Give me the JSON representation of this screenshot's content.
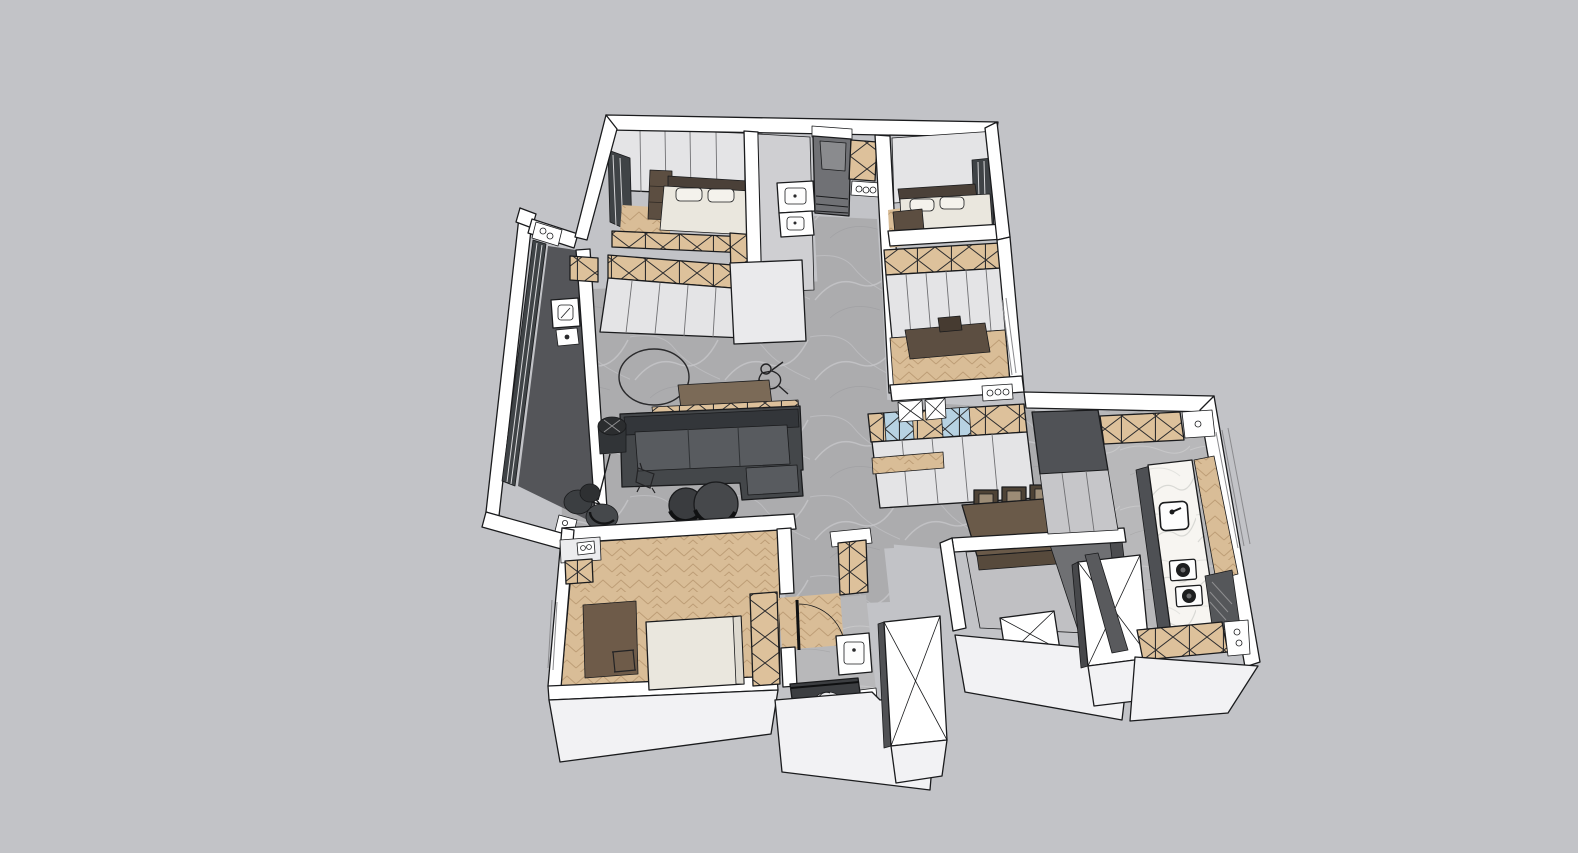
{
  "meta": {
    "title": "SketchUp-style 3D apartment floor plan model, top-down axonometric view on plain gray background",
    "application_chrome": "none",
    "visible_text": "none"
  },
  "palette": {
    "bg": "#c2c3c7",
    "wall": "#ffffff",
    "wallface": "#f2f2f4",
    "line": "#1a1b1d",
    "face": "#e4e4e6",
    "faceshade": "#cfcfd2",
    "facedark": "#9a9b9e",
    "concrete": "#acacae",
    "concvein": "#c7c7c9",
    "tile": "#b8b8ba",
    "wood": "#d9bd97",
    "woodline": "#bd9d76",
    "xwood": "#ddc19b",
    "xblue": "#b7d2e2",
    "darkwood": "#5c4e41",
    "headboard": "#4a4038",
    "cream": "#eae7de",
    "marble": "#f7f5f1",
    "glass": "#3f4346",
    "darkfloor": "#545559",
    "sofa": "#44474a",
    "sofaback": "#33363a",
    "sofaseat": "#585b5f",
    "tabletop": "#6a5a49",
    "shadowface": "#6f7073"
  },
  "scene": {
    "type": "3d-floor-plan-render",
    "style": "sketchup-white-model",
    "rooms": [
      {
        "name": "master-bedroom",
        "position": "top-left",
        "items": [
          "double-bed",
          "white-pillows",
          "dark-headboard",
          "dresser",
          "nightstand",
          "herringbone-floor",
          "x-front-wardrobe"
        ]
      },
      {
        "name": "vanity-bathroom",
        "position": "top-middle",
        "items": [
          "two-vanity-sinks"
        ]
      },
      {
        "name": "entry-hall",
        "position": "top-middle",
        "items": [
          "dark-entry-floor",
          "steps",
          "shoe-cabinet-x",
          "vent-plate"
        ]
      },
      {
        "name": "bedroom-2",
        "position": "top-right",
        "items": [
          "double-bed",
          "dark-headboard",
          "bench",
          "window-strip"
        ]
      },
      {
        "name": "study",
        "position": "middle-right",
        "items": [
          "x-front-wardrobe",
          "desk",
          "herringbone-floor"
        ]
      },
      {
        "name": "living-room",
        "position": "center",
        "items": [
          "l-shaped-sofa",
          "back-console-with-cushions",
          "floor-lamp",
          "two-round-coffee-tables",
          "circle-rug-outline",
          "person-sketch",
          "tv-wall-cabinets",
          "concrete-floor"
        ]
      },
      {
        "name": "balcony",
        "position": "left",
        "items": [
          "full-height-glazing",
          "dark-floor",
          "wash-basin",
          "lounge-chairs"
        ]
      },
      {
        "name": "bedroom-3",
        "position": "bottom-left",
        "items": [
          "bed",
          "brown-rug",
          "x-front-wardrobe",
          "herringbone-floor"
        ]
      },
      {
        "name": "bathroom",
        "position": "bottom-middle",
        "items": [
          "door-swing-arc",
          "vanity-sink",
          "dark-shower",
          "toilet",
          "towel-plate"
        ]
      },
      {
        "name": "laundry-wc",
        "position": "bottom-center-right",
        "items": [
          "washing-machine-x-panel",
          "dark-inner-walls"
        ]
      },
      {
        "name": "dining-area",
        "position": "center-right",
        "items": [
          "dark-dining-table",
          "three-chairs",
          "sideboard-x-and-blue-glass",
          "wood-shelf"
        ]
      },
      {
        "name": "kitchen",
        "position": "right",
        "items": [
          "marble-counter",
          "sink",
          "two-burner-cooktop",
          "tall-dark-cabinets",
          "x-front-upper-cabinets",
          "wood-cabinet-side",
          "x-front-base-cabinets"
        ]
      }
    ],
    "service_blocks": [
      "shaft-block-a-x-top",
      "shaft-block-b-x-top"
    ],
    "floor_finishes": {
      "living": "gray-concrete",
      "bedrooms": "herringbone-oak",
      "kitchen_bath": "gray-tile",
      "balcony": "dark-gray"
    }
  }
}
